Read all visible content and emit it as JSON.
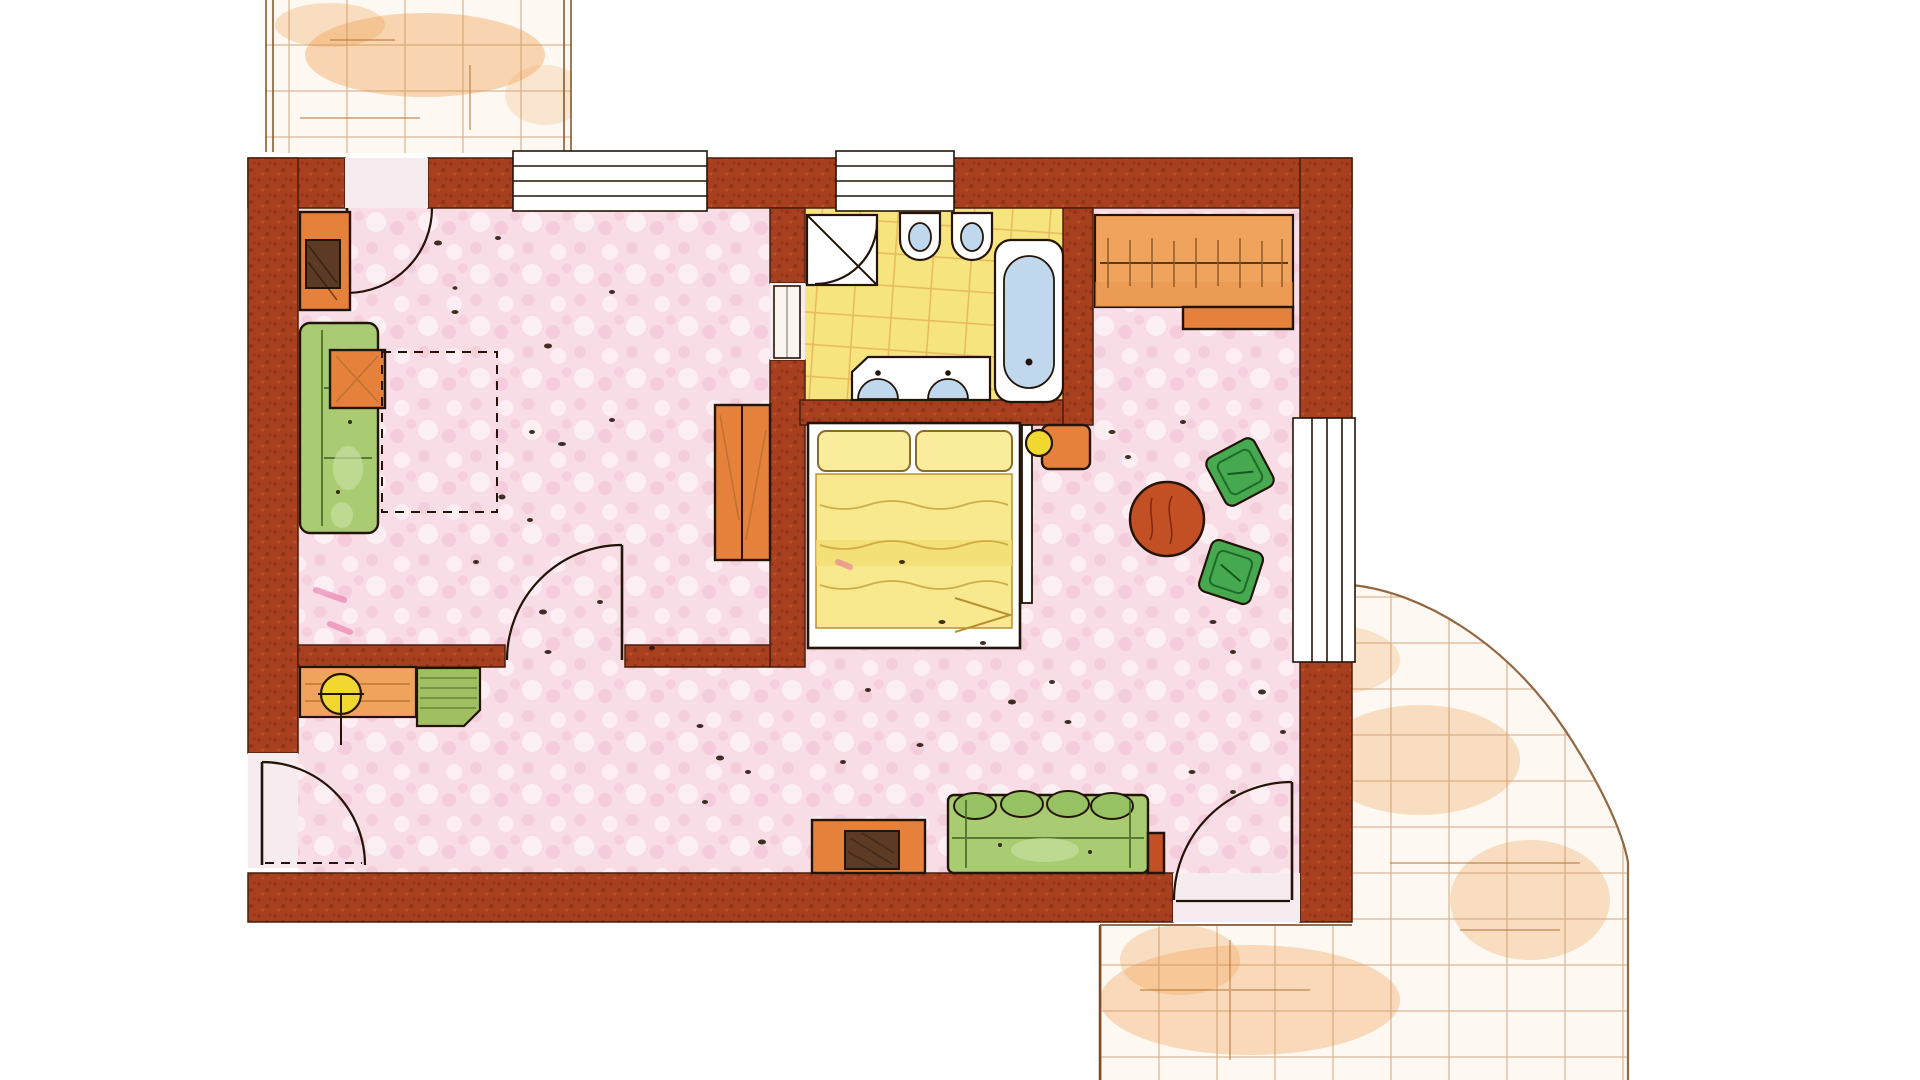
{
  "document": {
    "type": "floor-plan",
    "style": "hand-drawn watercolor apartment floor plan",
    "visible_text": []
  },
  "colors": {
    "background": "#FFFFFF",
    "wall": "#A8401F",
    "wall_edge": "#4A1E0C",
    "ink": "#241407",
    "floor_pink": "#F8DCE6",
    "floor_pink_deep": "#F2BCD1",
    "door_opening": "#F6ECEF",
    "bathroom_yellow": "#F6E47E",
    "tile_line": "#D9953F",
    "terrace_bg": "#FDF8F1",
    "terrace_line": "#C89058",
    "terrace_edge": "#936742",
    "terrace_wash": "#F0A050",
    "wood": "#E6813B",
    "wood_light": "#F0A35C",
    "wood_dark": "#B5702E",
    "sofa_green": "#A9CC72",
    "sofa_blotch": "#C8DFA0",
    "chair_green": "#46A94F",
    "bench_green": "#9FBF62",
    "table_red": "#C34F24",
    "bed_yellow": "#F8E98F",
    "pillow_yellow": "#F9EC9C",
    "fixture_white": "#FFFFFF",
    "water_blue": "#BFD8EE",
    "tv_brown": "#5C3A24",
    "lamp_yellow": "#F0D830",
    "accent_pink": "#E86AA0"
  },
  "rooms": [
    {
      "id": "living-room",
      "floor": "pink wash"
    },
    {
      "id": "hallway",
      "floor": "pink wash"
    },
    {
      "id": "bathroom",
      "floor": "yellow tiles"
    },
    {
      "id": "bedroom",
      "floor": "pink wash"
    },
    {
      "id": "sitting-dining-area",
      "floor": "pink wash"
    },
    {
      "id": "terrace-top",
      "floor": "terracotta tiles"
    },
    {
      "id": "terrace-bottom-right",
      "floor": "terracotta tiles"
    }
  ],
  "furniture": {
    "living_room": [
      "media-cabinet",
      "sofa",
      "coffee-table",
      "rug-outline",
      "wardrobe"
    ],
    "hallway": [
      "desk",
      "desk-lamp",
      "bench"
    ],
    "bathroom": [
      "corner-shower",
      "wall-hung-toilet",
      "wall-hung-bidet",
      "bathtub",
      "double-washbasin-vanity"
    ],
    "bedroom": [
      "double-bed",
      "pillow",
      "pillow",
      "nightstand",
      "bedside-lamp"
    ],
    "sitting_dining_area": [
      "closet-with-rail",
      "closet-bench",
      "round-table",
      "chair",
      "chair",
      "sofa",
      "tv-cabinet",
      "side-table"
    ]
  },
  "openings": {
    "windows": [
      "top-wall-living-room-window",
      "top-wall-bathroom-window",
      "right-wall-sitting-area-window"
    ],
    "doors": [
      "terrace-door-top",
      "bathroom-door",
      "living-room-door",
      "entrance-door",
      "terrace-door-bottom-right"
    ]
  }
}
